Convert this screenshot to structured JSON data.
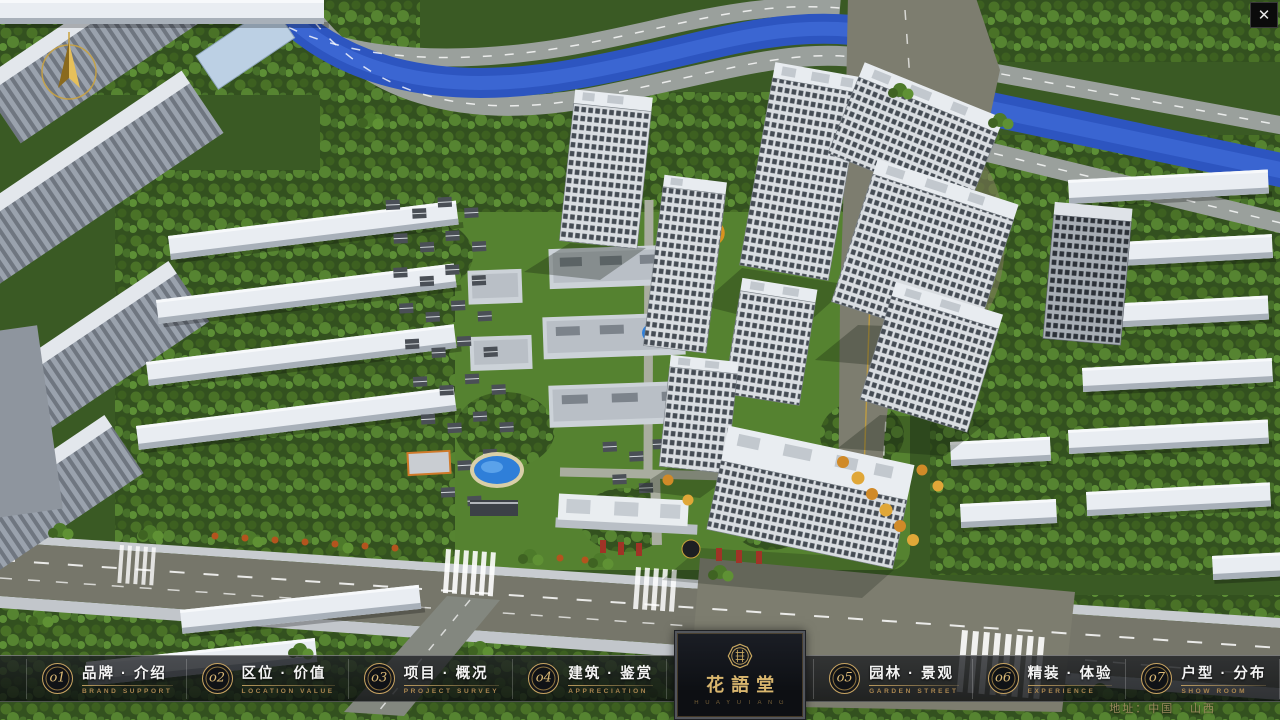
{
  "window": {
    "close_glyph": "✕"
  },
  "nav": {
    "items": [
      {
        "num": "o1",
        "label": "品牌 · 介绍",
        "caption": "BRAND SUPPORT"
      },
      {
        "num": "o2",
        "label": "区位 · 价值",
        "caption": "LOCATION VALUE"
      },
      {
        "num": "o3",
        "label": "项目 · 概况",
        "caption": "PROJECT SURVEY"
      },
      {
        "num": "o4",
        "label": "建筑 · 鉴赏",
        "caption": "APPRECIATION"
      },
      {
        "num": "o5",
        "label": "园林 · 景观",
        "caption": "GARDEN STREET"
      },
      {
        "num": "o6",
        "label": "精装 · 体验",
        "caption": "EXPERIENCE"
      },
      {
        "num": "o7",
        "label": "户型 · 分布",
        "caption": "SHOW ROOM"
      },
      {
        "num": "o8",
        "label": "一房 · 一景",
        "caption": "COMMUNITY"
      }
    ]
  },
  "logo": {
    "title": "花語堂",
    "subtext": "H U A Y U T A N G"
  },
  "footer": {
    "address": "地址：中国 · 山西"
  },
  "colors": {
    "gold": "#c8a462",
    "bar_bg": "#14161a",
    "river": "#2d55c0"
  }
}
